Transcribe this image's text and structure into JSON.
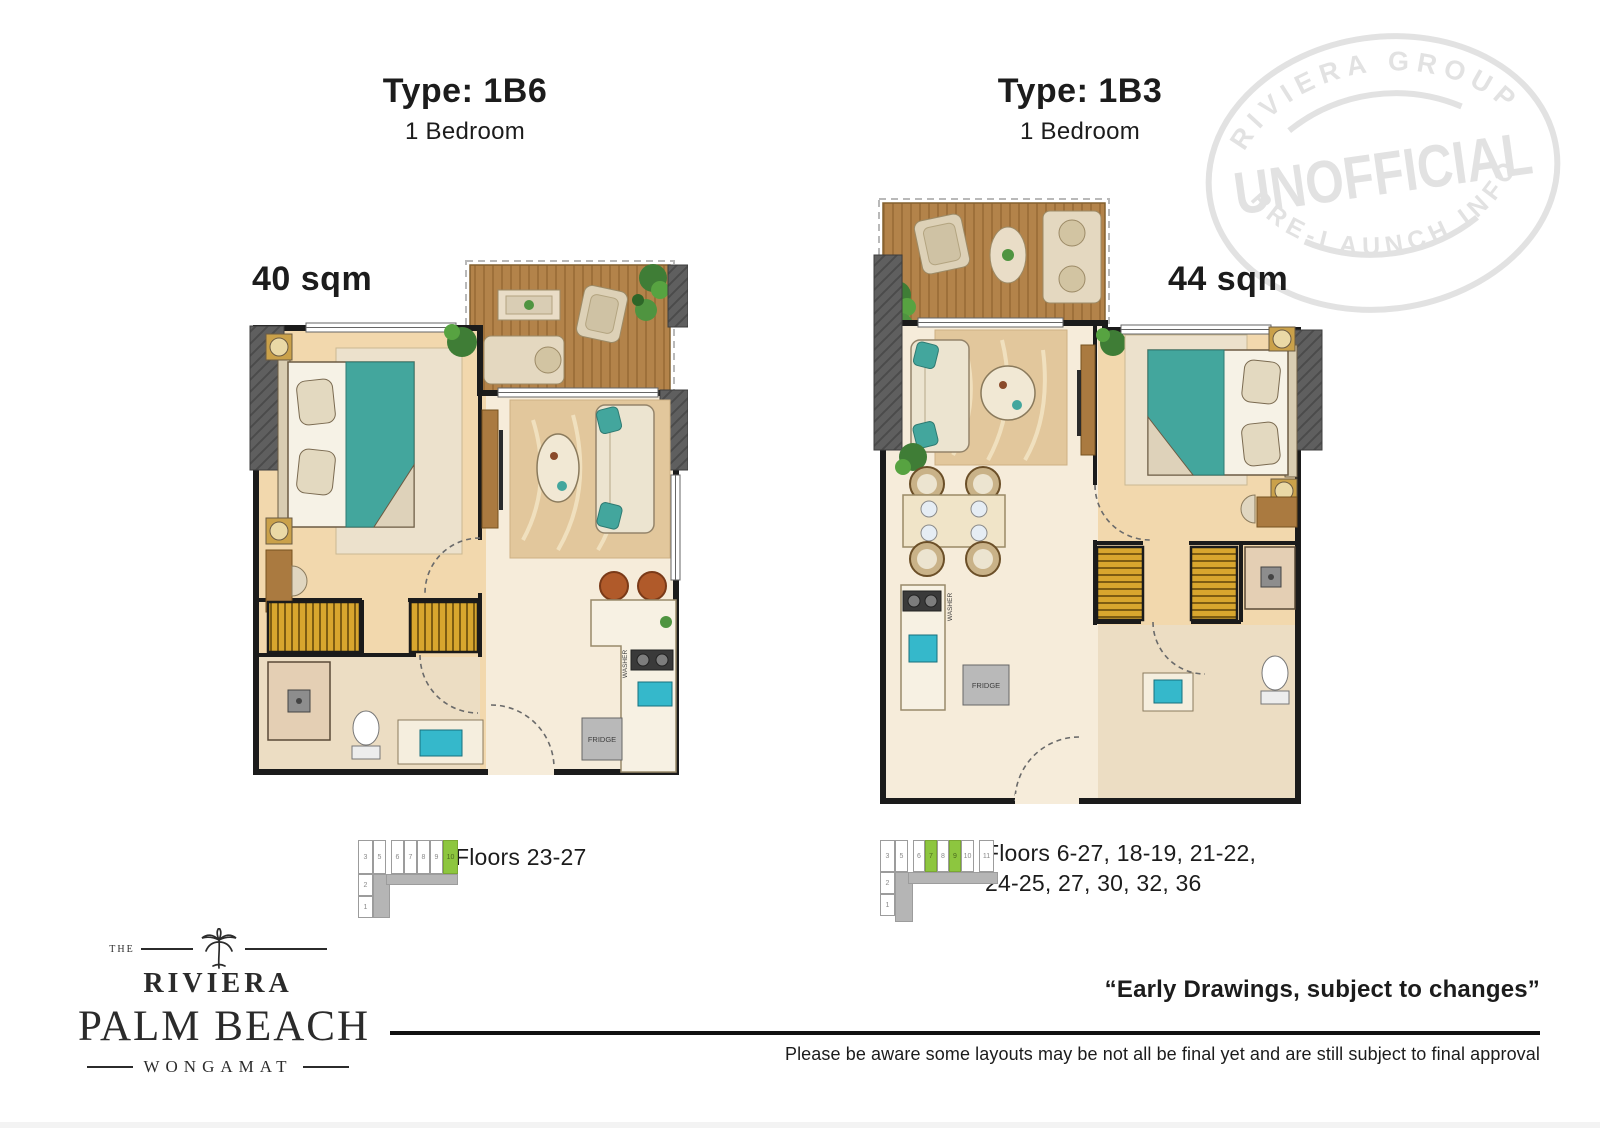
{
  "plans": [
    {
      "id": "1B6",
      "type_label": "Type: 1B6",
      "bedroom_label": "1 Bedroom",
      "area_label": "40 sqm",
      "floors_label": "Floors 23-27",
      "fridge_label": "FRIDGE",
      "washer_label": "WASHER",
      "keyplan": {
        "row": [
          {
            "label": "3",
            "active": false
          },
          {
            "label": "5",
            "active": false
          },
          {
            "label": "6",
            "active": false
          },
          {
            "label": "7",
            "active": false
          },
          {
            "label": "8",
            "active": false
          },
          {
            "label": "9",
            "active": false
          },
          {
            "label": "10",
            "active": true
          }
        ],
        "column": [
          {
            "label": "2",
            "active": false
          },
          {
            "label": "1",
            "active": false
          }
        ]
      }
    },
    {
      "id": "1B3",
      "type_label": "Type: 1B3",
      "bedroom_label": "1 Bedroom",
      "area_label": "44 sqm",
      "floors_label": "Floors 6-27, 18-19, 21-22, 24-25, 27, 30, 32, 36",
      "fridge_label": "FRIDGE",
      "washer_label": "WASHER",
      "keyplan": {
        "row": [
          {
            "label": "3",
            "active": false
          },
          {
            "label": "5",
            "active": false
          },
          {
            "label": "6",
            "active": false
          },
          {
            "label": "7",
            "active": true
          },
          {
            "label": "8",
            "active": false
          },
          {
            "label": "9",
            "active": true
          },
          {
            "label": "10",
            "active": false
          },
          {
            "label": "11",
            "active": false
          }
        ],
        "column": [
          {
            "label": "2",
            "active": false
          },
          {
            "label": "1",
            "active": false
          }
        ]
      }
    }
  ],
  "watermark": {
    "arc_top": "RIVIERA GROUP",
    "center": "UNOFFICIAL",
    "arc_bottom": "PRE-LAUNCH INFO"
  },
  "logo": {
    "the": "THE",
    "brand": "RIVIERA",
    "name": "PALM BEACH",
    "location": "WONGAMAT"
  },
  "footer": {
    "quote": "“Early Drawings, subject to changes”",
    "disclaimer": "Please be aware some layouts may be not all be final yet and are still subject to final approval"
  },
  "colors": {
    "keyplan_highlight": "#8dc63f",
    "stamp_gray": "#e2e2e2",
    "wall_black": "#1b1b1b",
    "bed_teal": "#43a69d",
    "sink_cyan": "#35b8cb",
    "wardrobe_gold": "#d8a62e",
    "deck_wood": "#b3834a"
  }
}
